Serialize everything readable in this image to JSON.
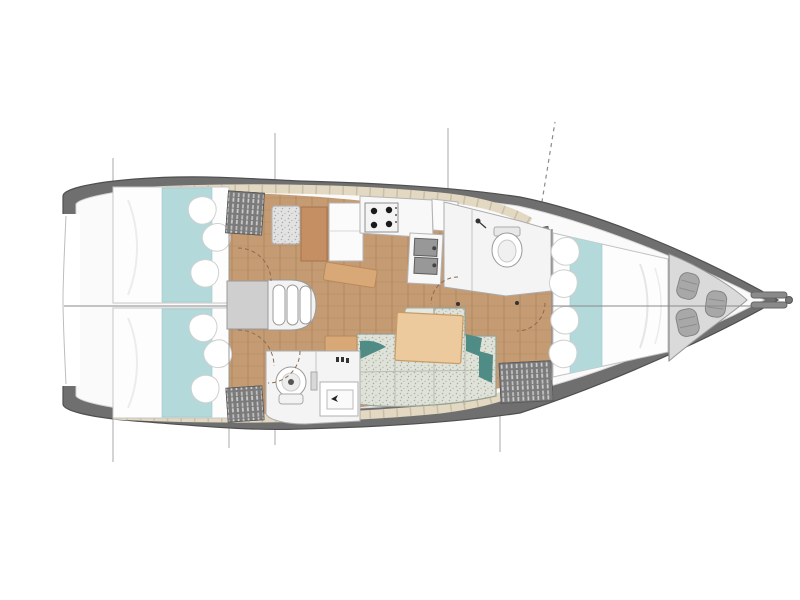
{
  "diagram": {
    "kind": "sailboat-interior-floor-plan",
    "view": "overhead-deck-plan",
    "bow_direction": "right",
    "stern_direction": "left",
    "features": {
      "cabins_total": 3,
      "aft_cabins": 2,
      "forward_cabins": 1,
      "heads": 2,
      "salon_sofa": 1,
      "galley_burners": 4,
      "galley_sinks": 2,
      "companionway_steps": 3,
      "anchor_locker_fenders": 3,
      "hanging_lockers": 4,
      "door_swing_arcs": 5,
      "section_lines": 6
    },
    "regions": [
      {
        "id": "aft-cabin-port"
      },
      {
        "id": "aft-cabin-starboard"
      },
      {
        "id": "companionway"
      },
      {
        "id": "nav-station"
      },
      {
        "id": "galley"
      },
      {
        "id": "forward-head"
      },
      {
        "id": "aft-head"
      },
      {
        "id": "salon"
      },
      {
        "id": "forward-cabin"
      },
      {
        "id": "anchor-locker"
      },
      {
        "id": "bow-fitting"
      }
    ]
  },
  "colors": {
    "background": "#ffffff",
    "hull_band": "#6f6f6f",
    "hull_outline": "#4f4f4f",
    "deck": "#fafafa",
    "deck_edge": "#d6d6d6",
    "floor_wood": "#c49b73",
    "trim_beige": "#e3d8c2",
    "trim_joint": "#c9bfa7",
    "bed_white": "#fdfdfd",
    "bed_outline": "#c6c6c6",
    "bed_runner_teal": "#b3d9da",
    "pillow_white": "#ffffff",
    "pillow_outline": "#d0d0d0",
    "sofa_fabric": "#dfe2d8",
    "sofa_outline": "#9aa094",
    "accent_pillow_teal": "#4f8c85",
    "table_wood": "#ecca9e",
    "table_outline": "#c79d66",
    "chart_table_wood": "#c58f63",
    "bench_wood": "#d9a877",
    "bench_outline": "#b8895b",
    "locker_dark": "#7b7b7b",
    "steps_gray": "#cfcfcf",
    "counter_white": "#f8f8f8",
    "sink_gray": "#989898",
    "head_floor": "#f4f4f4",
    "fixture_white": "#ffffff",
    "fixture_outline": "#9a9a9a",
    "anchor_locker_gray": "#dadada",
    "fender_gray": "#a8a8a8",
    "section_line": "#9a9a9a",
    "centerline": "#8a8a8a",
    "swing_arc": "#8a6b52",
    "burner_black": "#1a1a1a",
    "metal_gray": "#8a8a8a"
  }
}
